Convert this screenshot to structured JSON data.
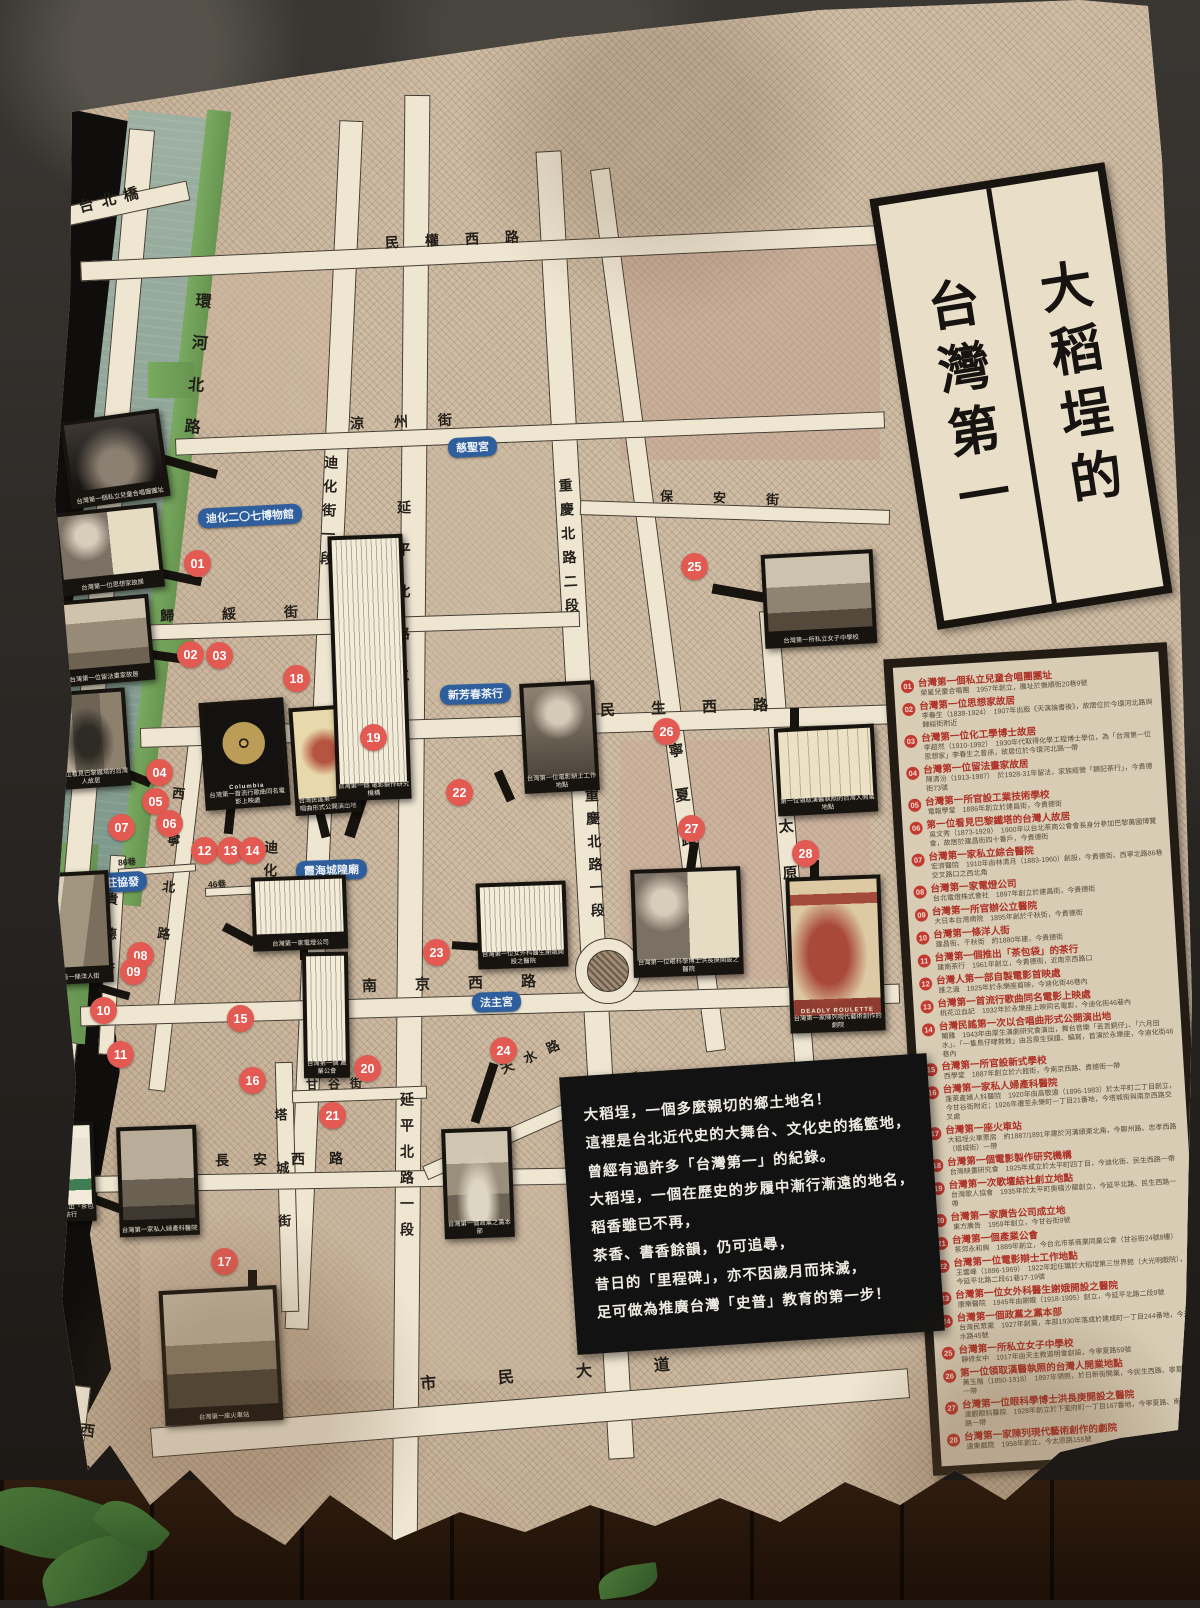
{
  "poster": {
    "title": {
      "right_col": "大稻埕的",
      "left_col": "台灣第一"
    },
    "intro_lines": [
      "大稻埕，一個多麼親切的鄉土地名！",
      "這裡是台北近代史的大舞台、文化史的搖籃地，",
      "曾經有過許多「台灣第一」的紀錄。",
      "大稻埕，一個在歷史的步履中漸行漸遠的地名，",
      "稻香雖已不再，",
      "茶香、書香餘韻，仍可追尋，",
      "昔日的「里程碑」，亦不因歲月而抹滅，",
      "足可做為推廣台灣「史普」教育的第一步！"
    ],
    "legend": [
      {
        "no": "01",
        "heading": "台灣第一個私立兒童合唱團團址",
        "detail": "榮星兒童合唱團　1957年創立，團址於撫順街20巷9號"
      },
      {
        "no": "02",
        "heading": "台灣第一位思想家故居",
        "detail": "李春生（1838-1924）　1907年出版《天演論書後》，故居位於今環河北路與歸綏街附近"
      },
      {
        "no": "03",
        "heading": "台灣第一位化工學博士故居",
        "detail": "李超然（1910-1992）　1930年代取得化學工程博士學位，為「台灣第一位思想家」李春生之曾孫，故居位於今環河北路一帶"
      },
      {
        "no": "04",
        "heading": "台灣第一位留法畫家故居",
        "detail": "陳清汾（1913-1987）　於1928-31年留法，家族經營「錦記茶行」，今貴德街73號"
      },
      {
        "no": "05",
        "heading": "台灣第一所官設工業技術學校",
        "detail": "電報學堂　1886年創立於建昌街，今貴德街"
      },
      {
        "no": "06",
        "heading": "第一位看見巴黎鐵塔的台灣人故居",
        "detail": "吳文秀（1873-1929）　1900年以台北茶商公會會長身分參加巴黎萬國博覽會，故居於建昌街四十番戶，今貴德街"
      },
      {
        "no": "07",
        "heading": "台灣第一家私立綜合醫院",
        "detail": "宏濟醫院　1910年由林清月（1883-1960）創設，今貴德街、西寧北路86巷交叉路口之西北角"
      },
      {
        "no": "08",
        "heading": "台灣第一家電燈公司",
        "detail": "台北電燈株式會社　1897年創立於建昌街，今貴德街"
      },
      {
        "no": "09",
        "heading": "台灣第一所官辦公立醫院",
        "detail": "大日本台灣病院　1895年創於千秋街，今貴德街"
      },
      {
        "no": "10",
        "heading": "台灣第一條洋人街",
        "detail": "建昌街、千秋街　約1880年建，今貴德街"
      },
      {
        "no": "11",
        "heading": "台灣第一個推出「茶包袋」的茶行",
        "detail": "建南茶行　1961年創立，今貴德街，近南京西路口"
      },
      {
        "no": "12",
        "heading": "台灣人第一部自製電影首映處",
        "detail": "誰之過　1925年於永樂座首映，今迪化街46巷內"
      },
      {
        "no": "13",
        "heading": "台灣第一首流行歌曲同名電影上映處",
        "detail": "桃花泣血記　1932年於永樂座上映同名電影，今迪化街46巷內"
      },
      {
        "no": "14",
        "heading": "台灣民謠第一次以合唱曲形式公開演出地",
        "detail": "閹雞　1943年由厚生演劇研究會演出，舞台音樂「丟丟銅仔」、「六月田水」、「一隻鳥仔哮救救」由呂泉生採譜、編寫，首演於永樂座，今迪化街46巷內"
      },
      {
        "no": "15",
        "heading": "台灣第一所官設新式學校",
        "detail": "西學堂　1887年創立於六館街，今南京西路、貴德街一帶"
      },
      {
        "no": "16",
        "heading": "台灣第一家私人婦產科醫院",
        "detail": "蓬萊產婦人科醫院　1920年由高敬遠（1896-1983）於太平町二丁目創立，今甘谷街附近；1926年遷至永樂町一丁目21番地，今塔城街與南京西路交叉處"
      },
      {
        "no": "17",
        "heading": "台灣第一座火車站",
        "detail": "大稻埕火車票房　約1887/1891年建於河溝頭東北角，今鄭州路、忠孝西路（塔城街）一帶"
      },
      {
        "no": "18",
        "heading": "台灣第一個電影製作研究機構",
        "detail": "台灣映畫研究會　1925年成立於太平町四丁目，今迪化街、民生西路一帶"
      },
      {
        "no": "19",
        "heading": "台灣第一次歌壇結社創立地點",
        "detail": "台灣歌人協會　1935年於太平町奧稽沙龍創立，今延平北路、民生西路一帶"
      },
      {
        "no": "20",
        "heading": "台灣第一家廣告公司成立地",
        "detail": "東方廣告　1959年創立，今甘谷街9號"
      },
      {
        "no": "21",
        "heading": "台灣第一個產業公會",
        "detail": "茶郊永和興　1889年創立，今台北市茶商業同業公會（甘谷街24號8樓）"
      },
      {
        "no": "22",
        "heading": "台灣第一位電影辯士工作地點",
        "detail": "王雲峰（1896-1969）　1922年起任職於大稻埕第三世界館（大光明戲院），今延平北路二段61巷17-19號"
      },
      {
        "no": "23",
        "heading": "台灣第一位女外科醫生謝娥開設之醫院",
        "detail": "康樂醫院　1945年由謝娥（1918-1995）創立，今延平北路二段9號"
      },
      {
        "no": "24",
        "heading": "台灣第一個政黨之黨本部",
        "detail": "台灣民眾黨　1927年創黨，本部1930年落成於建成町一丁目244番地，今天水路45號"
      },
      {
        "no": "25",
        "heading": "台灣第一所私立女子中學校",
        "detail": "靜修女中　1917年由天主教道明會創設，今寧夏路59號"
      },
      {
        "no": "26",
        "heading": "第一位領取漢醫執照的台灣人開業地點",
        "detail": "黃玉階（1850-1918）　1897年領照，於日新街開業，今民生西路、寧夏路一帶"
      },
      {
        "no": "27",
        "heading": "台灣第一位眼科學博士洪長庚開設之醫院",
        "detail": "達觀眼科醫院　1928年創立於下奎府町一丁目167番地，今寧夏路、南京西路一帶"
      },
      {
        "no": "28",
        "heading": "台灣第一家陳列現代藝術創作的劇院",
        "detail": "遠東戲院　1958年創立，今太原路155號"
      }
    ],
    "map": {
      "street_labels": [
        "台北橋",
        "環河北路",
        "環河",
        "西寧北路",
        "迪化街一段",
        "迪化街一段",
        "延平北路二段",
        "延平北路一段",
        "重慶北路二段",
        "重慶北路一段",
        "寧夏路",
        "太原路",
        "貴德街",
        "西寧北路",
        "塔城街",
        "民權西路",
        "涼州街",
        "歸綏街",
        "保安街",
        "民生西路",
        "南京西路",
        "長安西路",
        "市民大道",
        "甘谷街",
        "天水路"
      ],
      "place_labels": [
        "迪化二〇七博物館",
        "慈聖宮",
        "新芳春茶行",
        "莊協發",
        "霞海城隍廟",
        "法主宮"
      ],
      "lane_labels": [
        "86巷",
        "46巷"
      ],
      "markers": [
        "01",
        "02",
        "03",
        "04",
        "05",
        "06",
        "07",
        "08",
        "09",
        "10",
        "11",
        "12",
        "13",
        "14",
        "15",
        "16",
        "17",
        "18",
        "19",
        "20",
        "21",
        "22",
        "23",
        "24",
        "25",
        "26",
        "27",
        "28"
      ],
      "photos": [
        {
          "cap": "台灣第一個私立兒童合唱團團址",
          "kind": "stage"
        },
        {
          "cap": "台灣第一位思想家故居",
          "kind": "portraitdoc"
        },
        {
          "cap": "台灣第一位留法畫家故居",
          "kind": "street"
        },
        {
          "cap": "第一位看見巴黎鐵塔的台灣人故居",
          "kind": "robe"
        },
        {
          "cap": "台灣第一條洋人街",
          "kind": "street2"
        },
        {
          "cap": "台灣第一個",
          "cap2": "推出「茶包袋」的茶行",
          "kind": "teabag",
          "inner": "TEA BAG"
        },
        {
          "cap": "台灣第一家私人婦產科醫院",
          "kind": "building"
        },
        {
          "cap": "台灣第一座火車站",
          "kind": "train"
        },
        {
          "cap": "台灣第一首流行歌曲同名電影上映處",
          "kind": "record",
          "inner": "Columbia"
        },
        {
          "cap": "台灣民謠第一次",
          "cap2": "以合唱曲形式公開演出地",
          "kind": "flyer"
        },
        {
          "cap": "台灣第一個",
          "cap2": "電影製作研究機構",
          "kind": "doc"
        },
        {
          "cap": "台灣第一家電燈公司",
          "kind": "doc"
        },
        {
          "cap": "台灣第一個",
          "cap2": "產業公會",
          "kind": "doc"
        },
        {
          "cap": "台灣第一位電影辯士工作地點",
          "kind": "portrait"
        },
        {
          "cap": "台灣第一位女外科醫生謝娥開設之醫院",
          "kind": "doc"
        },
        {
          "cap": "台灣第一個政黨之黨本部",
          "kind": "group"
        },
        {
          "cap": "台灣第一所私立女子中學校",
          "kind": "building2"
        },
        {
          "cap": "第一位領取漢醫執照的台灣人開業地點",
          "kind": "letter"
        },
        {
          "cap": "台灣第一位眼科學博士洪長庚開設之醫院",
          "kind": "portraitdoc"
        },
        {
          "cap": "台灣第一家陳列現代藝術創作的劇院",
          "kind": "posterred",
          "inner": "DEADLY ROULETTE"
        }
      ]
    }
  }
}
